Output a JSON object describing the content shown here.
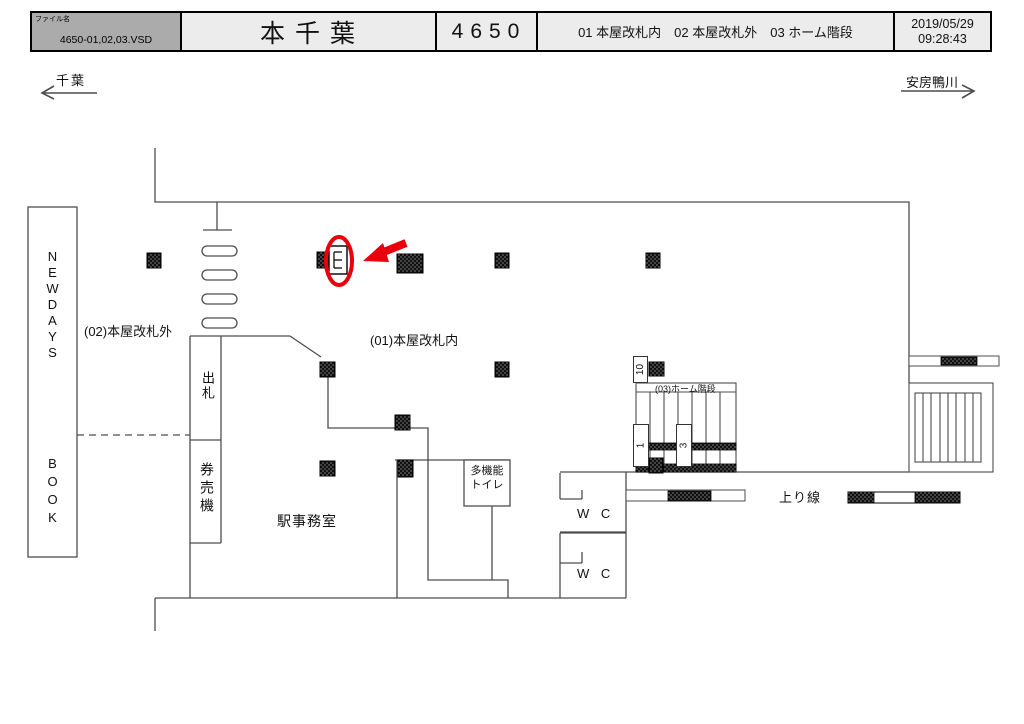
{
  "header": {
    "file_label": "ファイル名",
    "file_name": "4650-01,02,03.VSD",
    "station_name": "本千葉",
    "station_number": "4650",
    "legend": "01 本屋改札内　02 本屋改札外　03 ホーム階段",
    "date": "2019/05/29",
    "time": "09:28:43"
  },
  "directions": {
    "left": "千葉",
    "right": "安房鴨川"
  },
  "plan": {
    "areas": {
      "newdays": "NEWDAYS",
      "book": "BOOK",
      "outside_gate": "(02)本屋改札外",
      "inside_gate": "(01)本屋改札内",
      "ticket_window": "出札",
      "ticket_machines": "券売機",
      "station_office": "駅事務室",
      "multi_toilet_line1": "多機能",
      "multi_toilet_line2": "トイレ",
      "wc_upper": "W C",
      "wc_lower": "W C",
      "platform_stairs": "(03)ホーム階段",
      "up_line": "上り線"
    },
    "position_numbers": {
      "pos10": "10",
      "pos1": "1",
      "pos3": "3"
    },
    "colors": {
      "highlight_red": "#e8000d",
      "header_gray": "#ababab",
      "line_gray": "#4d4d4d"
    }
  }
}
